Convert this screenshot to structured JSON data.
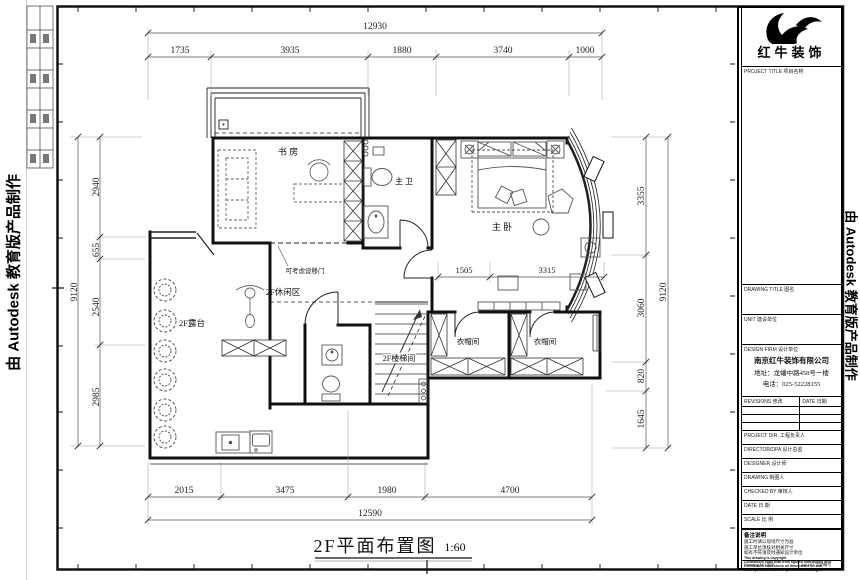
{
  "edge_notes": {
    "left": "由 Autodesk 教育版产品制作",
    "right": "由 Autodesk 教育版产品制作"
  },
  "drawing_title": {
    "name": "2F平面布置图",
    "scale": "1:60"
  },
  "rooms": {
    "study": "书 房",
    "master_bath": "主 卫",
    "master_bedroom": "主 卧",
    "leisure": "2F休闲区",
    "terrace": "2F露台",
    "stairwell": "2F楼梯间",
    "cloakroom_left": "衣帽间",
    "cloakroom_right": "衣帽间"
  },
  "annotations": {
    "sliding_door": "可考虑设移门"
  },
  "dimensions": {
    "top_total": "12930",
    "top": [
      "1735",
      "3935",
      "1880",
      "3740",
      "1000"
    ],
    "left_total": "9120",
    "left": [
      "2940",
      "655",
      "2540",
      "2985"
    ],
    "right_total": "9120",
    "right": [
      "3355",
      "3060",
      "820",
      "1645"
    ],
    "bottom_total": "12590",
    "bottom": [
      "2015",
      "3475",
      "1980",
      "4700"
    ],
    "bedroom": [
      "1505",
      "3315"
    ]
  },
  "title_block": {
    "logo_text": "红牛装饰",
    "project_title_label": "PROJECT TITLE 项目名称",
    "drawing_title_label": "DRAWING TITLE 图名",
    "unit_label": "UNIT 建设单位",
    "design_firm_label": "DESIGN FIRM 设计单位",
    "firm_name": "南京红牛装饰有限公司",
    "firm_address": "地址：龙蟠中路458号一楼",
    "firm_phone": "电话：025-52228155",
    "revisions_label": "REVISIONS 修改",
    "revision_date_label": "DATE 日期",
    "rows": [
      {
        "label": "PROJECT DIR. 工程负责人"
      },
      {
        "label": "DIRECTOR/DPA 设计总监"
      },
      {
        "label": "DESIGNER 设计师"
      },
      {
        "label": "DRAWING 制图人"
      },
      {
        "label": "CHECKED BY 审核人"
      },
      {
        "label": "DATE 日 期"
      },
      {
        "label": "SCALE 比 例"
      }
    ],
    "notes_title": "备注说明",
    "notes_zh": [
      "施工时请以现场尺寸为准",
      "施工单位须核对相关尺寸",
      "如有不符请及时通知设计单位"
    ],
    "notes_en": [
      "This drawing is copyright",
      "Contractors shall read from figured dimensions only",
      "Contractors must check all dimensions on site",
      "Discrepancies must be reported to the designer"
    ],
    "drawing_no_label": "Drawing NO 图号",
    "job_no_label": "Job NO 工程编号"
  }
}
